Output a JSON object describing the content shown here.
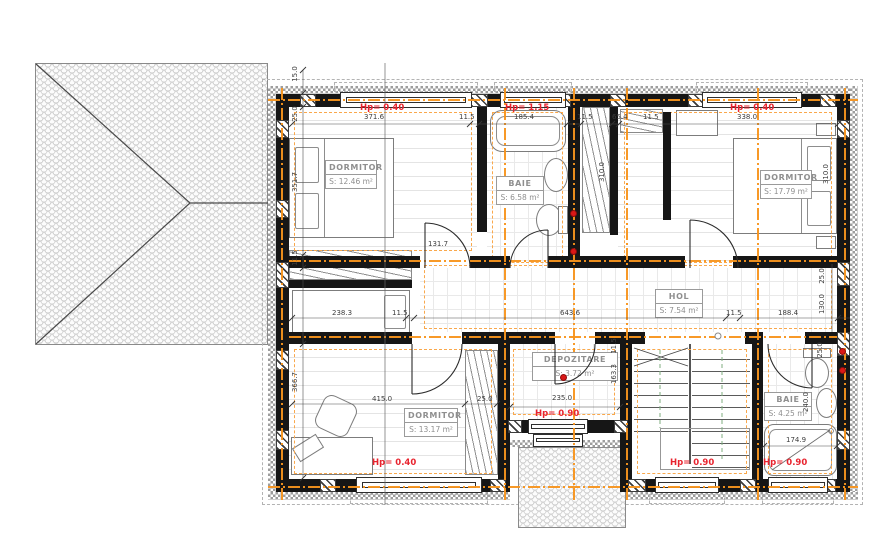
{
  "drawing": {
    "type": "floor-plan-with-roof-view",
    "colors": {
      "wall": "#161616",
      "axis_orange": "#F7941D",
      "envelope_orange": "#F9A84C",
      "hp_red": "#E8232E",
      "outlet_red": "#DA1717",
      "dim_text": "#3d3d3d",
      "label_gray": "#8f8f8f"
    }
  },
  "rooms": [
    {
      "id": "dormitor-1",
      "name": "DORMITOR",
      "area": "S: 12.46 m²"
    },
    {
      "id": "baie-1",
      "name": "BAIE",
      "area": "S: 6.58 m²"
    },
    {
      "id": "dormitor-2",
      "name": "DORMITOR",
      "area": "S: 17.79 m²"
    },
    {
      "id": "hol",
      "name": "HOL",
      "area": "S: 7.54 m²"
    },
    {
      "id": "depozitare",
      "name": "DEPOZITARE",
      "area": "S: 3.72 m²"
    },
    {
      "id": "dormitor-3",
      "name": "DORMITOR",
      "area": "S: 13.17 m²"
    },
    {
      "id": "baie-2",
      "name": "BAIE",
      "area": "S: 4.25 m²"
    }
  ],
  "hp_labels": [
    {
      "text": "Hp= 0.40"
    },
    {
      "text": "Hp= 1.15"
    },
    {
      "text": "Hp= 0.40"
    },
    {
      "text": "Hp= 0.40"
    },
    {
      "text": "Hp= 0.90"
    },
    {
      "text": "Hp= 0.90"
    },
    {
      "text": "Hp= 0.90"
    }
  ],
  "dimensions": {
    "top_chain": [
      "371.6",
      "11.5",
      "185.4",
      "11.5",
      "65.4",
      "11.5",
      "338.0"
    ],
    "middle_chain": [
      "238.3",
      "11.5",
      "643.6",
      "11.5",
      "188.4"
    ],
    "left_chain": [
      "15.0",
      "25.0",
      "351.7",
      "11.5",
      "366.7"
    ],
    "right_area": [
      "310.0",
      "25.0",
      "130.0"
    ],
    "room_dims": [
      "131.7",
      "310.0",
      "415.0",
      "25.0",
      "235.0",
      "163.3",
      "11.5",
      "174.9",
      "25.0",
      "240.0"
    ]
  }
}
